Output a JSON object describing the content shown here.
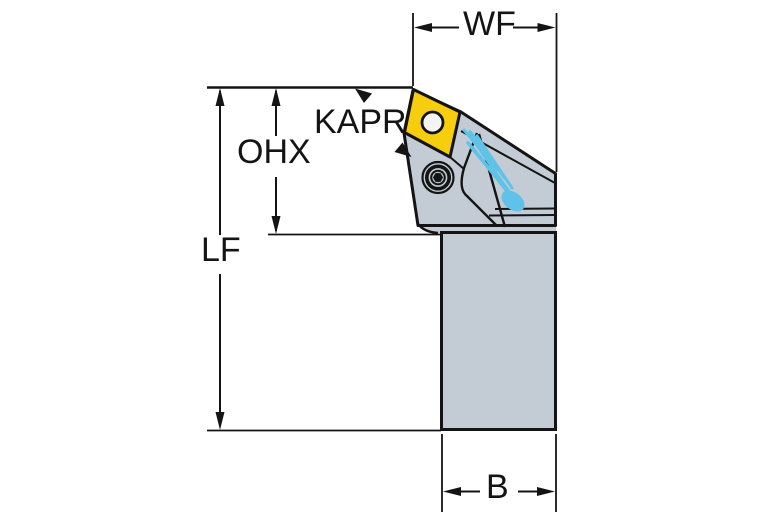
{
  "diagram": {
    "type": "technical-dimension-drawing",
    "subject": "turning tool holder with diamond insert",
    "labels": {
      "wf": "WF",
      "kapr": "KAPR",
      "ohx": "OHX",
      "lf": "LF",
      "b": "B"
    },
    "colors": {
      "body_gray": "#C3CCD4",
      "insert_yellow": "#F6CE0D",
      "chip_blue": "#5FC2E9",
      "line": "#141414",
      "background": "#FFFFFF",
      "hole_white": "#F4F4F2"
    }
  }
}
